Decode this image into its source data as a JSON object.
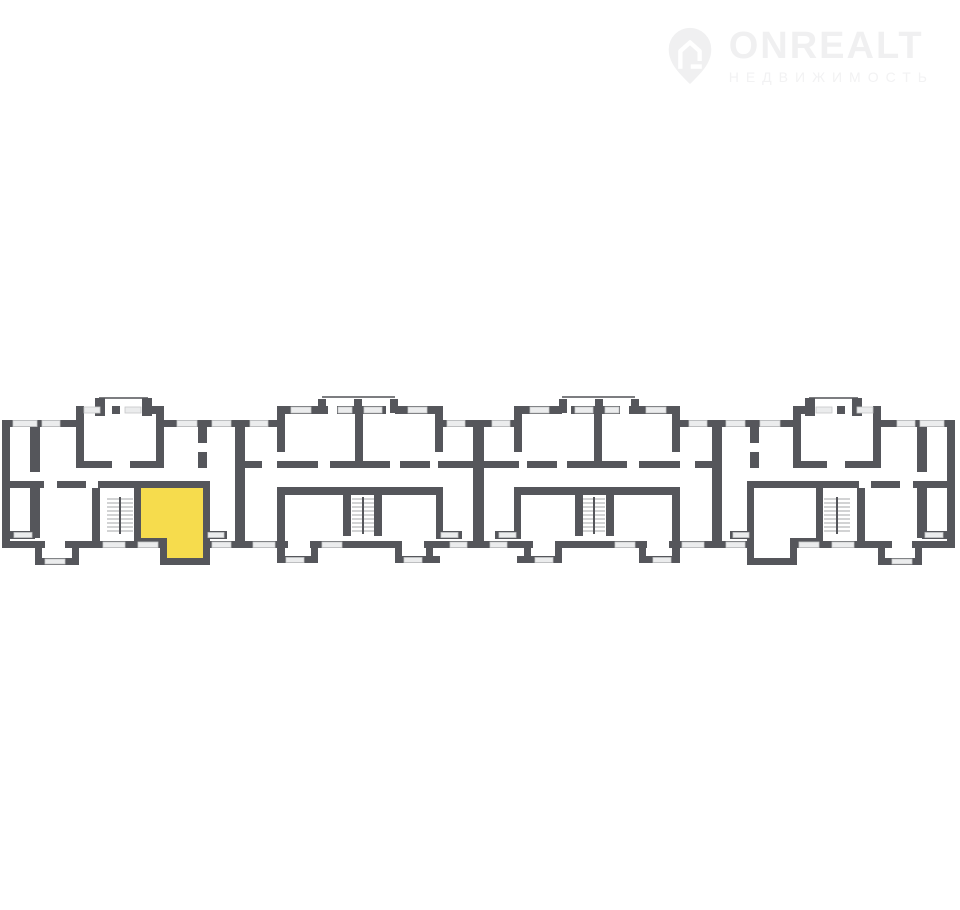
{
  "watermark": {
    "brand": "ONREALT",
    "tagline": "НЕДВИЖИМОСТЬ"
  },
  "floor_plan": {
    "type": "residential-building-floor-plan",
    "sections": 4,
    "staircases": 4,
    "balconies": 6,
    "highlighted_unit": {
      "section": 1,
      "position": "right-of-staircase",
      "fill": "#F6DC4D"
    }
  },
  "colors": {
    "background": "#FFFFFF",
    "wall": "#55565B",
    "window_fill": "#EBECED",
    "window_border": "#C6C7C9",
    "stair": "#A6A7A9",
    "balcony": "#7C7D80",
    "unit": "#F6DC4D",
    "watermark": "#F2F2F3",
    "watermark_strong": "#F0F0F1"
  }
}
